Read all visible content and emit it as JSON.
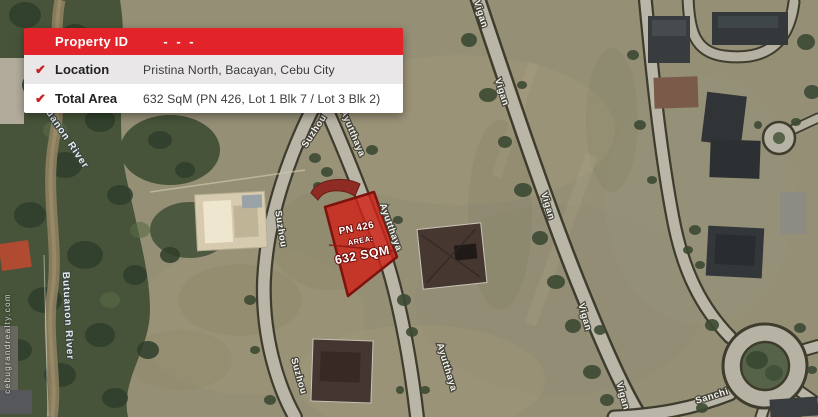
{
  "info_card": {
    "header": {
      "label": "Property ID",
      "value": "- - -"
    },
    "check_icon": "✔",
    "rows": [
      {
        "label": "Location",
        "value": "Pristina North, Bacayan, Cebu City"
      },
      {
        "label": "Total Area",
        "value": "632 SqM (PN 426, Lot 1 Blk 7 / Lot 3 Blk 2)"
      }
    ],
    "accent_color": "#e2232a"
  },
  "property_overlay": {
    "id": "PN 426",
    "area_label": "AREA:",
    "area_value": "632 SQM",
    "fill_color": "#cf2318",
    "border_color": "#7e130e"
  },
  "map": {
    "street_labels": [
      {
        "text": "Vigan"
      },
      {
        "text": "Vigan"
      },
      {
        "text": "Vigan"
      },
      {
        "text": "Vigan"
      },
      {
        "text": "Vigan"
      },
      {
        "text": "Suzhou"
      },
      {
        "text": "Suzhou"
      },
      {
        "text": "Suzhou"
      },
      {
        "text": "Ayutthaya"
      },
      {
        "text": "Ayutthaya"
      },
      {
        "text": "Ayutthaya"
      },
      {
        "text": "Sanchi"
      }
    ],
    "river_labels": [
      {
        "text": "Butuanon River"
      },
      {
        "text": "Butuanon River"
      }
    ],
    "watermark": "cebugrandrealty.com"
  }
}
